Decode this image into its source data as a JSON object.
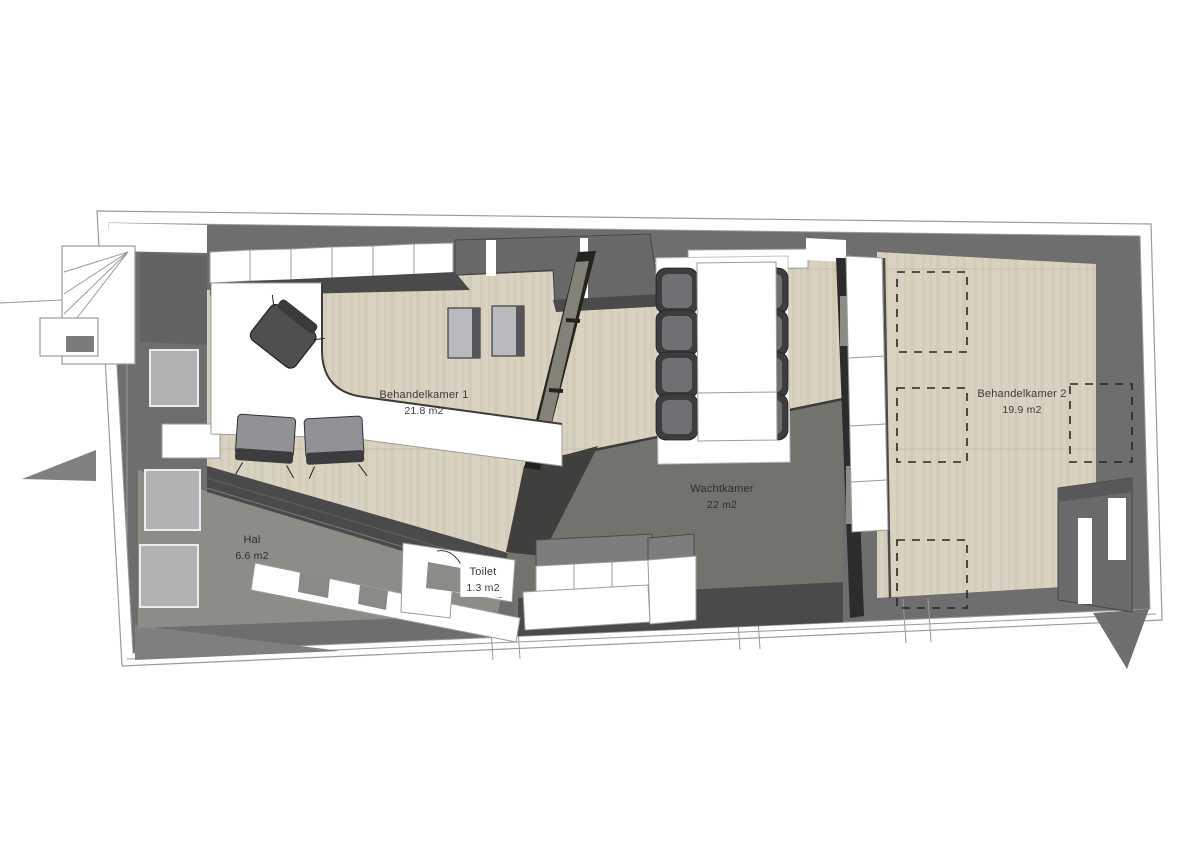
{
  "plan": {
    "type": "3d-floorplan-top-view",
    "rooms": [
      {
        "name": "Behandelkamer 1",
        "area": "21.8 m2"
      },
      {
        "name": "Wachtkamer",
        "area": "22 m2"
      },
      {
        "name": "Behandelkamer 2",
        "area": "19.9 m2"
      },
      {
        "name": "Hal",
        "area": "6.6 m2"
      },
      {
        "name": "Toilet",
        "area": "1.3 m2"
      }
    ],
    "colors": {
      "wall_gray": "#6e6e6e",
      "wall_shadow": "#3f3f3f",
      "floor_wood": "#d9d2c0",
      "floor_wood_stripe": "#cdc6b1",
      "floor_waiting": "#73736e",
      "floor_hall": "#8d8d88",
      "outline_gray": "#9a9a9a",
      "furniture_white": "#ffffff",
      "chair_dark": "#3d3d3d"
    }
  }
}
